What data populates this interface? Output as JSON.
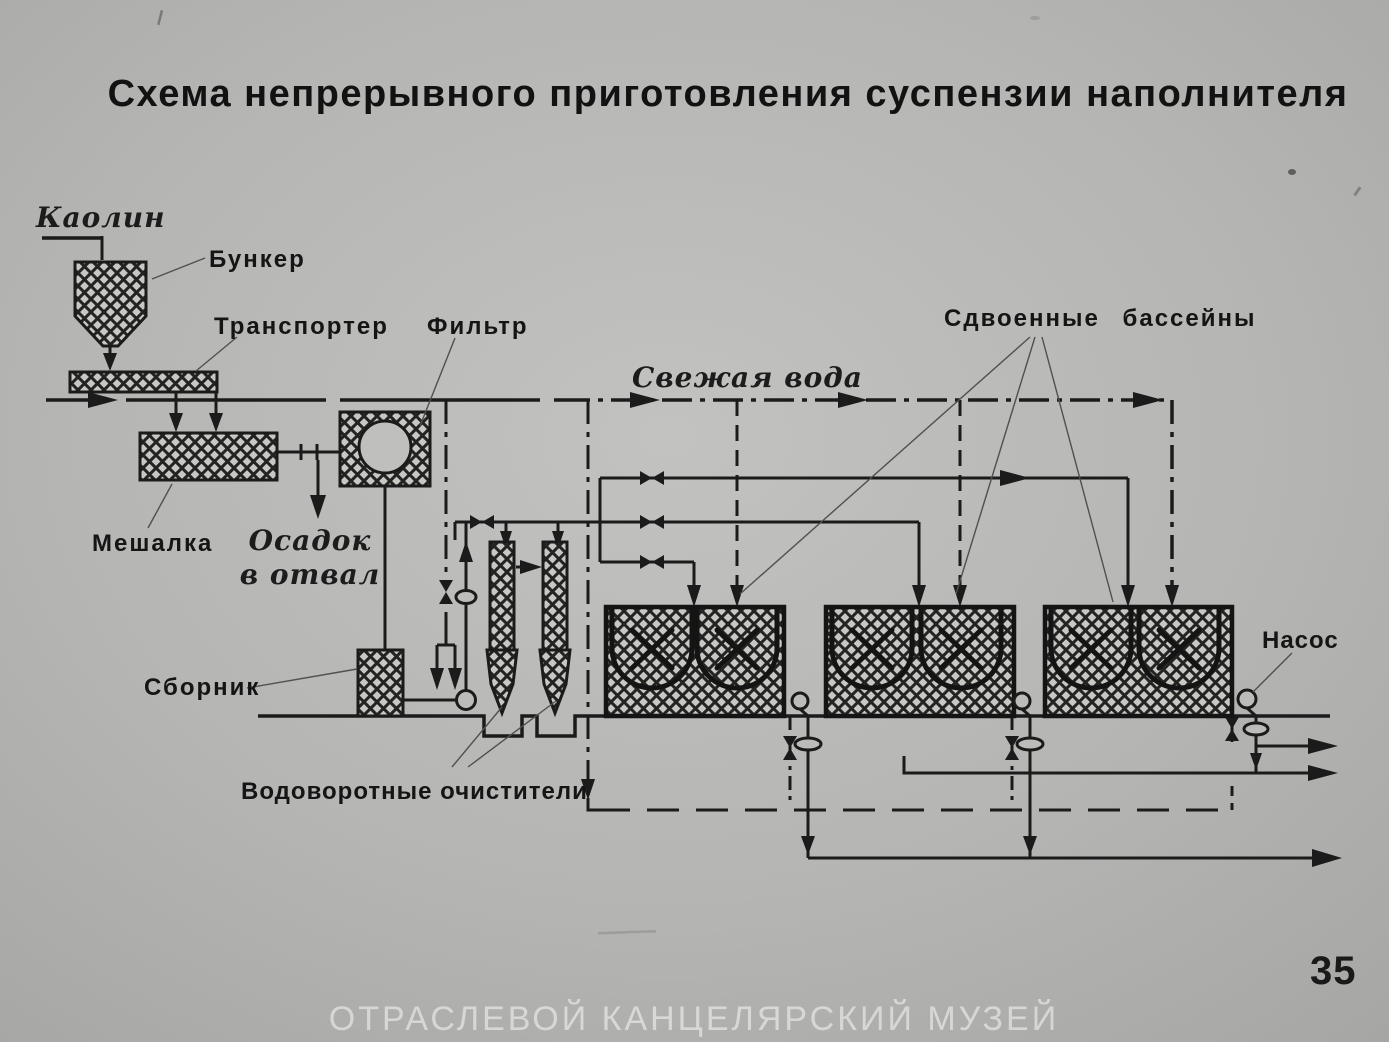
{
  "slide": {
    "title": "Схема непрерывного приготовления суспензии наполнителя",
    "page_number": "35",
    "watermark": "ОТРАСЛЕВОЙ КАНЦЕЛЯРСКИЙ МУЗЕЙ"
  },
  "labels": {
    "kaolin": "Каолин",
    "hopper": "Бункер",
    "conveyor": "Транспортер",
    "filter": "Фильтр",
    "fresh_water": "Свежая вода",
    "twin_basins": "Сдвоенные бассейны",
    "mixer": "Мешалка",
    "sediment_line1": "Осадок",
    "sediment_line2": "в отвал",
    "collector": "Сборник",
    "vortex_cleaners": "Водоворотные очистители",
    "pump": "Насос"
  },
  "colors": {
    "background": "#b5b5b3",
    "ink": "#1b1b1b",
    "hatch_fill": "#c7c7c4",
    "watermark": "rgba(255,255,255,0.5)"
  }
}
